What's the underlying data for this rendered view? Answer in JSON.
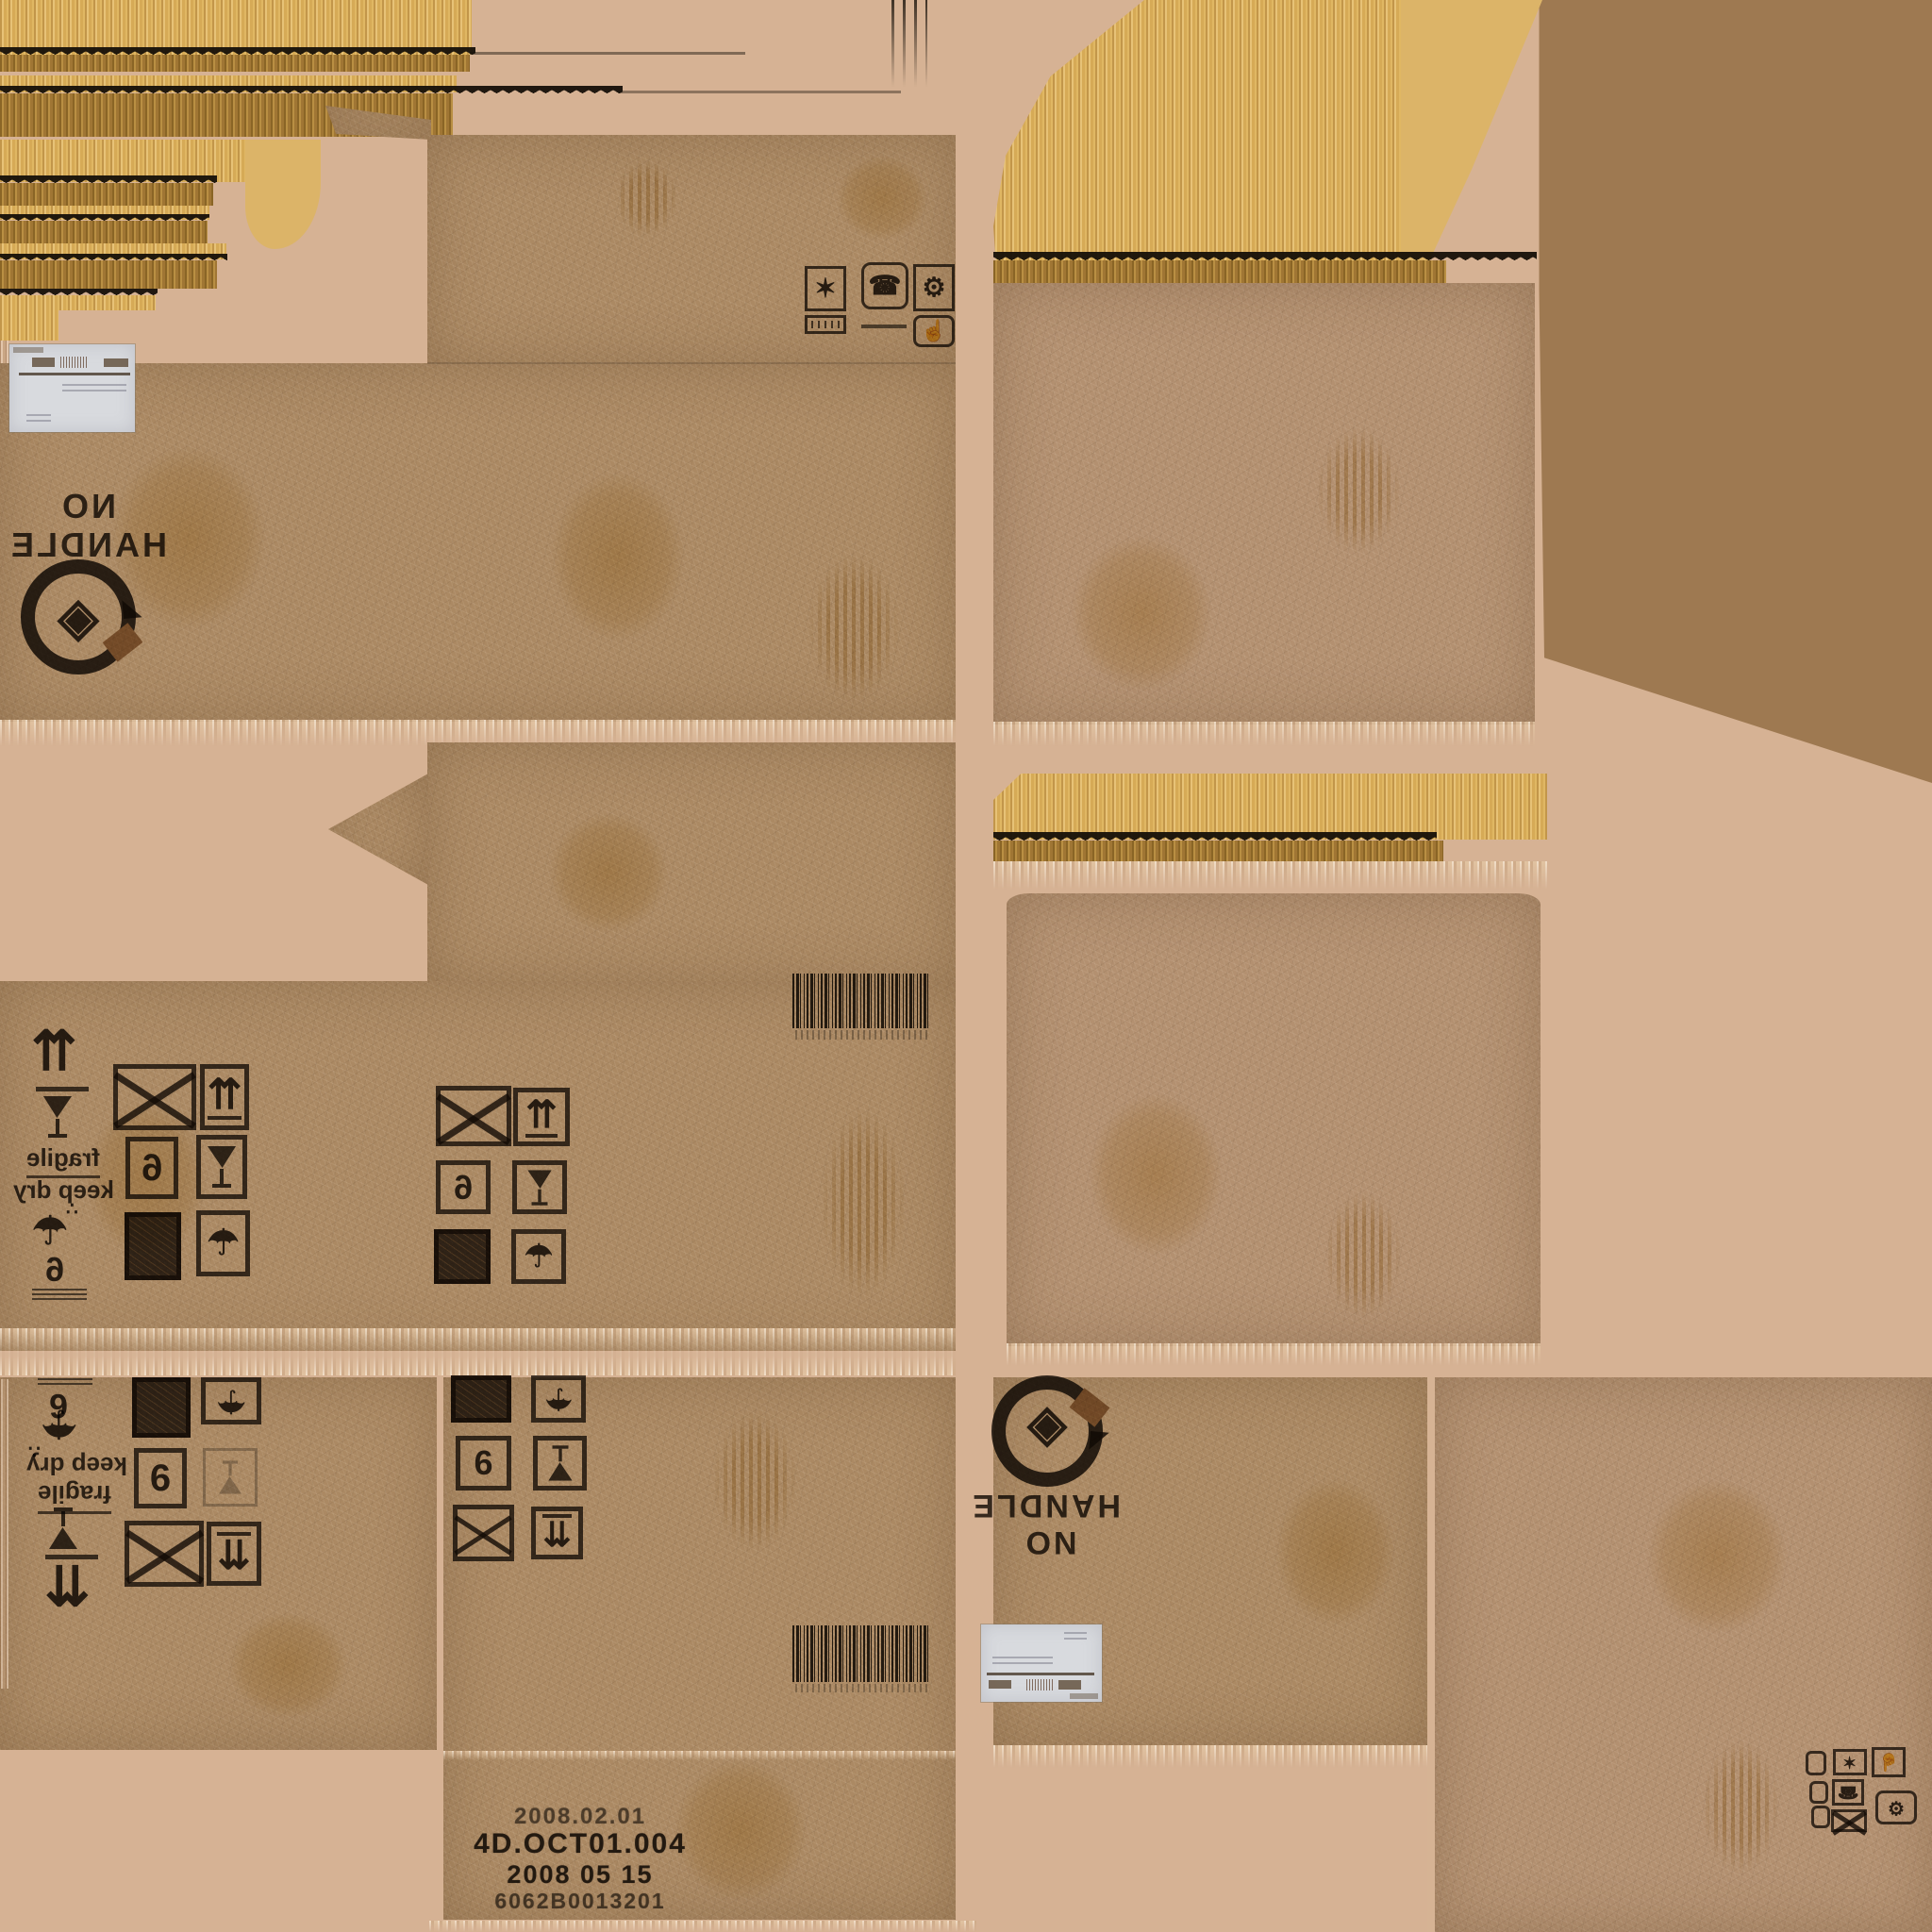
{
  "colors": {
    "background": "#d6b294",
    "cardboard": "#ab8963",
    "cardboard_light": "#b39070",
    "corrugation_yellow": "#dfb566",
    "corrugation_shadow": "#a87f3f",
    "flat_brown": "#9e7951",
    "flat_yellow": "#dcb468",
    "ink": "#221b12",
    "label_white": "#d8dade",
    "stain_yellow": "#cdaa48"
  },
  "stamps": {
    "no_handle_line1": "NO",
    "no_handle_line2": "HANDLE",
    "fragile": "fragile",
    "keep_dry": "keep dry",
    "number": "6"
  },
  "print_block": {
    "line1": "2008.02.01",
    "line2": "4D.OCT01.004",
    "line3": "2008 05 15",
    "line4": "6062B0013201"
  },
  "glyphs": {
    "up_arrows": "⇈",
    "down_arrows": "⇊",
    "umbrella": "☂",
    "rain_dots": "∴",
    "star": "✶",
    "hand": "☝",
    "telephone": "☎",
    "gear": "⚙",
    "box_logo": "◈"
  }
}
